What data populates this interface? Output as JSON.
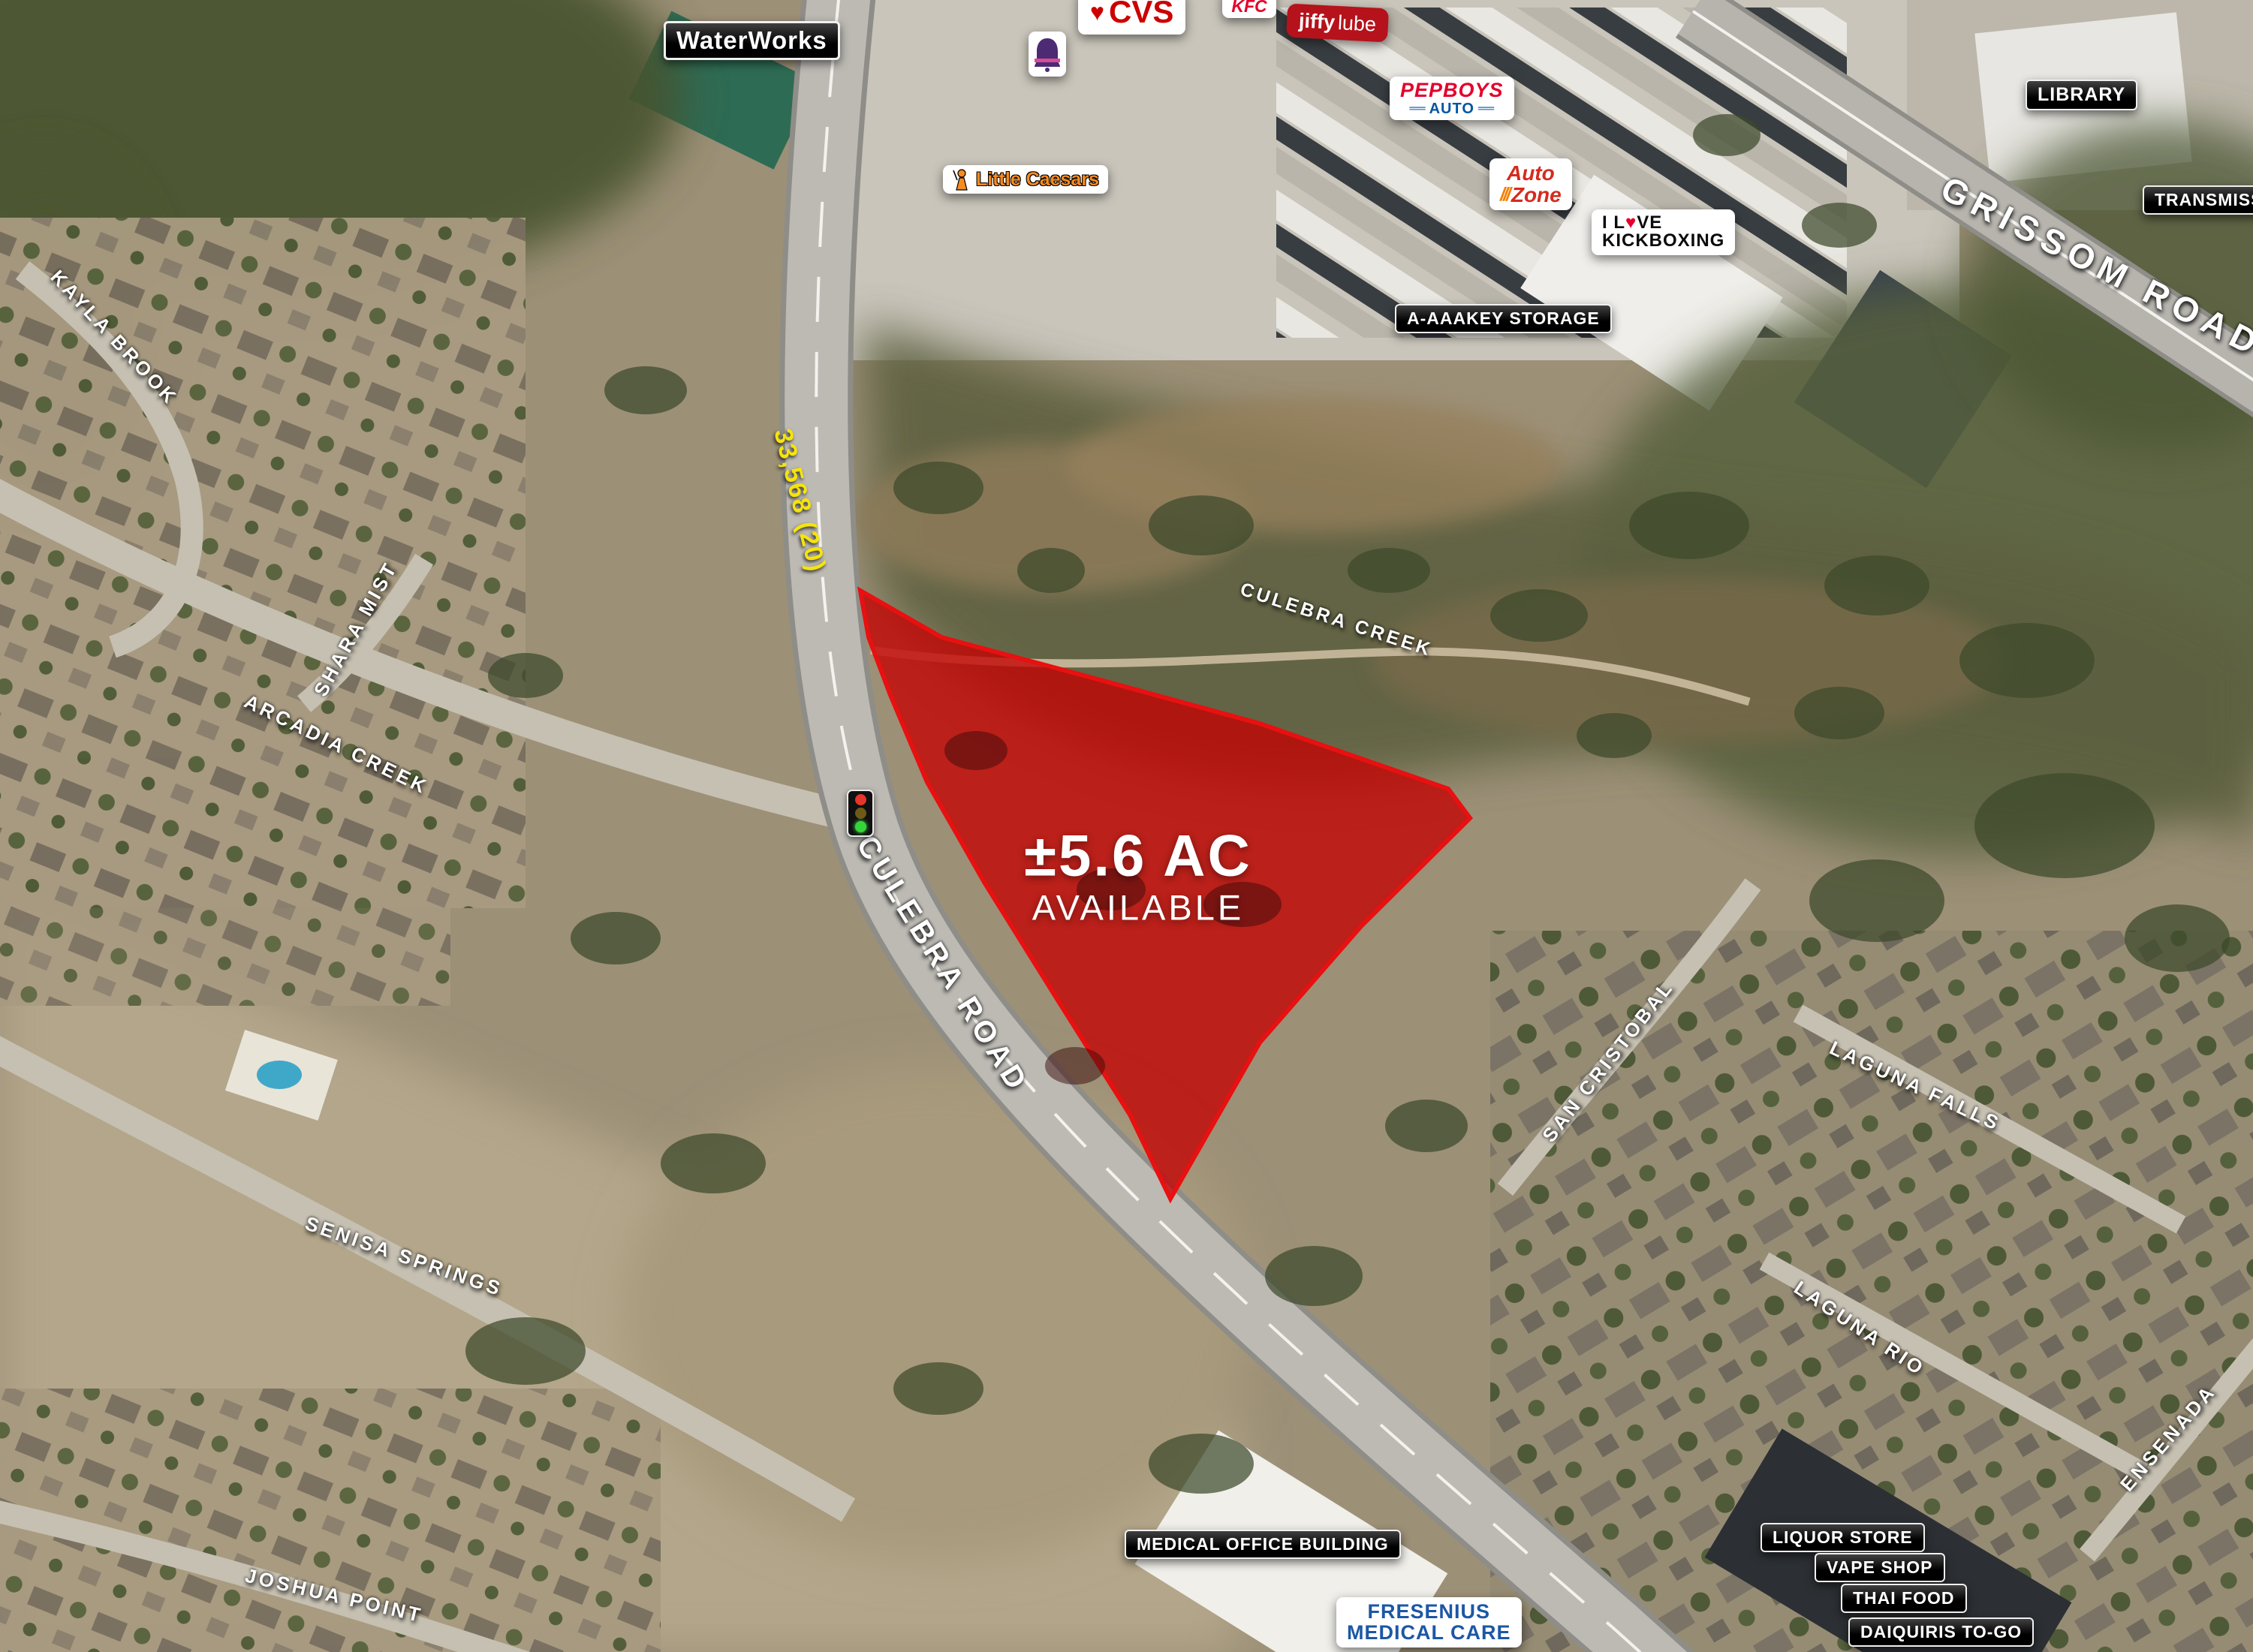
{
  "parcel": {
    "area": "±5.6 AC",
    "status": "AVAILABLE",
    "fill_color": "#c40000"
  },
  "traffic": {
    "count_label": "33,568 (20)",
    "color": "#f5e40c"
  },
  "roads": {
    "culebra": "CULEBRA ROAD",
    "grissom": "GRISSOM ROAD"
  },
  "waterways": {
    "culebra_creek": "CULEBRA CREEK"
  },
  "streets": {
    "kayla_brook": "KAYLA BROOK",
    "shara_mist": "SHARA MIST",
    "arcadia_creek": "ARCADIA CREEK",
    "senisa_springs": "SENISA SPRINGS",
    "joshua_point": "JOSHUA POINT",
    "san_cristobal": "SAN CRISTOBAL",
    "laguna_falls": "LAGUNA FALLS",
    "laguna_rio": "LAGUNA RIO",
    "ensenada": "ENSENADA"
  },
  "pois": {
    "waterworks": "WaterWorks",
    "storage": "A-AAAKEY STORAGE",
    "library": "LIBRARY",
    "transmission": "TRANSMISSION",
    "medical_office": "MEDICAL OFFICE BUILDING",
    "liquor_store": "LIQUOR STORE",
    "vape_shop": "VAPE SHOP",
    "thai_food": "THAI FOOD",
    "daiquiris": "DAIQUIRIS TO-GO"
  },
  "brands": {
    "cvs": {
      "heart": "♥",
      "text": "CVS",
      "color": "#cc0000"
    },
    "kfc": {
      "text": "KFC",
      "color": "#e4002b"
    },
    "jiffy_lube": {
      "word1": "jiffy",
      "word2": "lube",
      "bg": "#b5121b"
    },
    "little_caesars": {
      "text": "Little Caesars",
      "color": "#f68b1f"
    },
    "pepboys": {
      "line1": "PEPBOYS",
      "bar_left": "══",
      "line2": "AUTO",
      "bar_right": "══",
      "color1": "#e4002b",
      "color2": "#0055a5"
    },
    "autozone": {
      "word1": "Auto",
      "slashes": "///",
      "word2": "Zone",
      "color": "#d52b1e",
      "slash_color": "#f37f00"
    },
    "kickboxing": {
      "line1_a": "I L",
      "heart": "♥",
      "line1_b": "VE",
      "line2": "KICKBOXING",
      "heart_color": "#e4002b"
    },
    "fresenius": {
      "line1": "FRESENIUS",
      "line2": "MEDICAL CARE",
      "color": "#1c57a5"
    }
  }
}
